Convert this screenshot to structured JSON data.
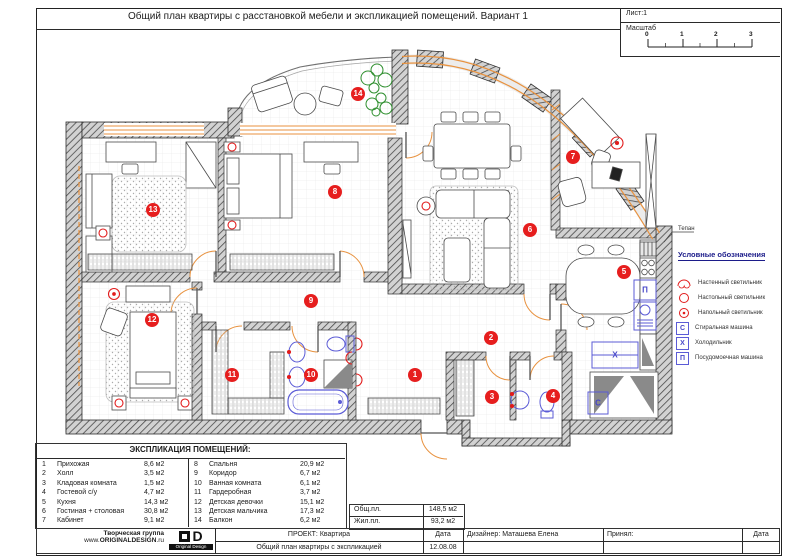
{
  "sheet": {
    "title": "Общий план квартиры с расстановкой мебели и экспликацией помещений. Вариант 1",
    "sheet_label": "Лист:1",
    "scale_label": "Масштаб",
    "scale_ticks": [
      "0",
      "1",
      "2",
      "3"
    ]
  },
  "plan": {
    "annotation": "Тепан",
    "room_badges": [
      {
        "n": "1"
      },
      {
        "n": "2"
      },
      {
        "n": "3"
      },
      {
        "n": "4"
      },
      {
        "n": "5"
      },
      {
        "n": "6"
      },
      {
        "n": "7"
      },
      {
        "n": "8"
      },
      {
        "n": "9"
      },
      {
        "n": "10"
      },
      {
        "n": "11"
      },
      {
        "n": "12"
      },
      {
        "n": "13"
      },
      {
        "n": "14"
      }
    ],
    "appliances": {
      "dishwasher": "П",
      "fridge": "Х",
      "washer": "С"
    }
  },
  "legend": {
    "title": "Условные обозначения",
    "items": [
      {
        "icon": "wall-lamp",
        "label": "Настенный светильник"
      },
      {
        "icon": "table-lamp",
        "label": "Настольный светильник"
      },
      {
        "icon": "floor-lamp",
        "label": "Напольный светильник"
      },
      {
        "icon": "washing-machine",
        "letter": "С",
        "label": "Стиральная машина"
      },
      {
        "icon": "fridge",
        "letter": "Х",
        "label": "Холодильник"
      },
      {
        "icon": "dishwasher",
        "letter": "П",
        "label": "Посудомоечная машина"
      }
    ]
  },
  "explication": {
    "title": "ЭКСПЛИКАЦИЯ ПОМЕЩЕНИЙ:",
    "left": [
      {
        "n": "1",
        "name": "Прихожая",
        "area": "8,6 м2"
      },
      {
        "n": "2",
        "name": "Холл",
        "area": "3,5 м2"
      },
      {
        "n": "3",
        "name": "Кладовая комната",
        "area": "1,5 м2"
      },
      {
        "n": "4",
        "name": "Гостевой с/у",
        "area": "4,7 м2"
      },
      {
        "n": "5",
        "name": "Кухня",
        "area": "14,3 м2"
      },
      {
        "n": "6",
        "name": "Гостиная + столовая",
        "area": "30,8 м2"
      },
      {
        "n": "7",
        "name": "Кабинет",
        "area": "9,1 м2"
      }
    ],
    "right": [
      {
        "n": "8",
        "name": "Спальня",
        "area": "20,9 м2"
      },
      {
        "n": "9",
        "name": "Коридор",
        "area": "6,7 м2"
      },
      {
        "n": "10",
        "name": "Ванная комната",
        "area": "6,1 м2"
      },
      {
        "n": "11",
        "name": "Гардеробная",
        "area": "3,7 м2"
      },
      {
        "n": "12",
        "name": "Детская девочки",
        "area": "15,1 м2"
      },
      {
        "n": "13",
        "name": "Детская мальчика",
        "area": "17,3 м2"
      },
      {
        "n": "14",
        "name": "Балкон",
        "area": "6,2 м2"
      }
    ]
  },
  "totals": {
    "general_label": "Общ.пл.",
    "general_value": "148,5 м2",
    "living_label": "Жил.пл.",
    "living_value": "93,2 м2"
  },
  "titleblock": {
    "studio_line1": "Творческая группа",
    "www_prefix": "www.",
    "domain": "ORIGINALDESIGN",
    "tld": ".ru",
    "logo_caption": "Original Design",
    "project": "ПРОЕКТ: Квартира",
    "drawing": "Общий план квартиры с экспликацией",
    "date_label": "Дата",
    "date": "12.08.08",
    "designer": "Дизайнер: Маташева Елена",
    "approved": "Принял:",
    "date2_label": "Дата"
  }
}
